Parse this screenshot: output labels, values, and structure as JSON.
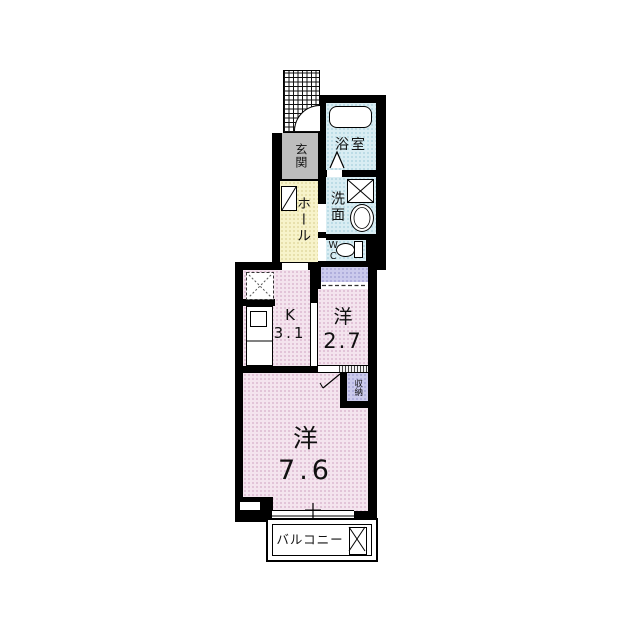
{
  "floorplan": {
    "rooms": {
      "entrance": {
        "label": "玄関"
      },
      "bathroom": {
        "label": "浴室"
      },
      "hall": {
        "label": "ホール"
      },
      "washroom": {
        "label": "洗面"
      },
      "wc": {
        "label": "WC"
      },
      "kitchen": {
        "label": "K",
        "area": "3.1"
      },
      "western_room_small": {
        "label": "洋",
        "area": "2.7"
      },
      "storage": {
        "label": "収納"
      },
      "western_room_large": {
        "label": "洋",
        "area": "7.6"
      },
      "balcony": {
        "label": "バルコニー"
      }
    },
    "colors": {
      "wall": "#000000",
      "room_pink": "#f4e4ee",
      "wet_area_blue": "#d9edf3",
      "hall_yellow": "#f7f3ca",
      "closet_purple": "#cbcaec",
      "entrance_gray": "#bdbdbd"
    },
    "fixtures": [
      "entrance-porch",
      "entrance-door",
      "bathtub",
      "bathroom-folding-door",
      "washing-machine-pan",
      "washbasin",
      "toilet",
      "shoe-cabinet",
      "refrigerator-space",
      "kitchen-counter",
      "kitchen-sink",
      "sliding-door",
      "storage-door",
      "balcony-window",
      "water-heater"
    ]
  }
}
